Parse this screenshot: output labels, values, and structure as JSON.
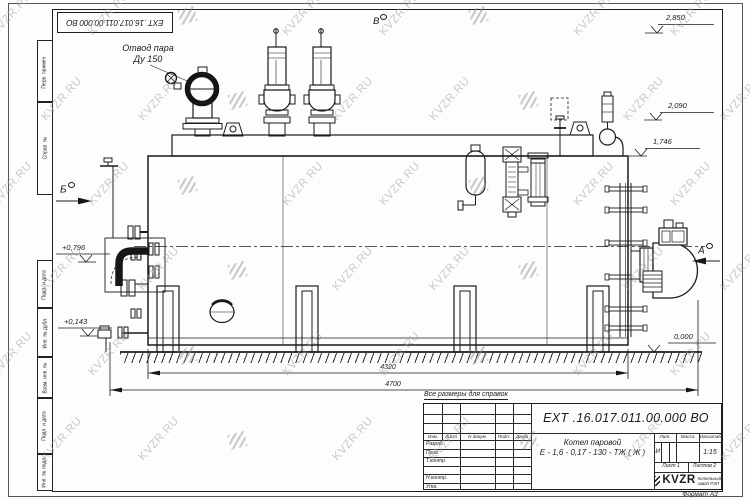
{
  "doc_number": "ЕХТ .16.017.011.00.000  ВО",
  "margin_labels": [
    "Перв. примен.",
    "Справ. №",
    "Подп. и дата",
    "Инв. № дубл.",
    "Взам. инв. №",
    "Подп. и дата",
    "Инв. № подл."
  ],
  "annotations": {
    "steam_outlet_line1": "Отвод пара",
    "steam_outlet_line2": "Ду 150",
    "view_v": "В",
    "view_b": "Б",
    "view_a": "А",
    "note": "Все размеры для справок",
    "format": "Формат А3"
  },
  "levels": {
    "top": "2,850",
    "mid": "2,090",
    "low": "1,746",
    "left_up": "+0,796",
    "left_dn": "+0,143",
    "zero": "0,000"
  },
  "dims": {
    "width_inner": "4320",
    "width_total": "4700"
  },
  "stamp": {
    "header": {
      "izm": "Изм.",
      "list": "Лист",
      "ndoc": "N докум.",
      "podp": "Подп.",
      "data": "Дата"
    },
    "rows": [
      "Разраб.",
      "Пров.",
      "Т.контр.",
      "",
      "Н.контр.",
      "Утв."
    ],
    "title_line1": "Котел паровой",
    "title_line2": "Е - 1,6 - 0,17 - 130 - ТЖ ( Ж )",
    "lit_label": "Лит.",
    "mass_label": "Масса",
    "scale_label": "Масштаб",
    "lit_value": "И",
    "scale_value": "1:15",
    "sheet": "Лист 1",
    "sheets": "Листов 2",
    "logo_text": "KVZR",
    "logo_sub1": "Котельный",
    "logo_sub2": "завод РЭП"
  },
  "watermark": {
    "text": "KVZR.RU"
  }
}
